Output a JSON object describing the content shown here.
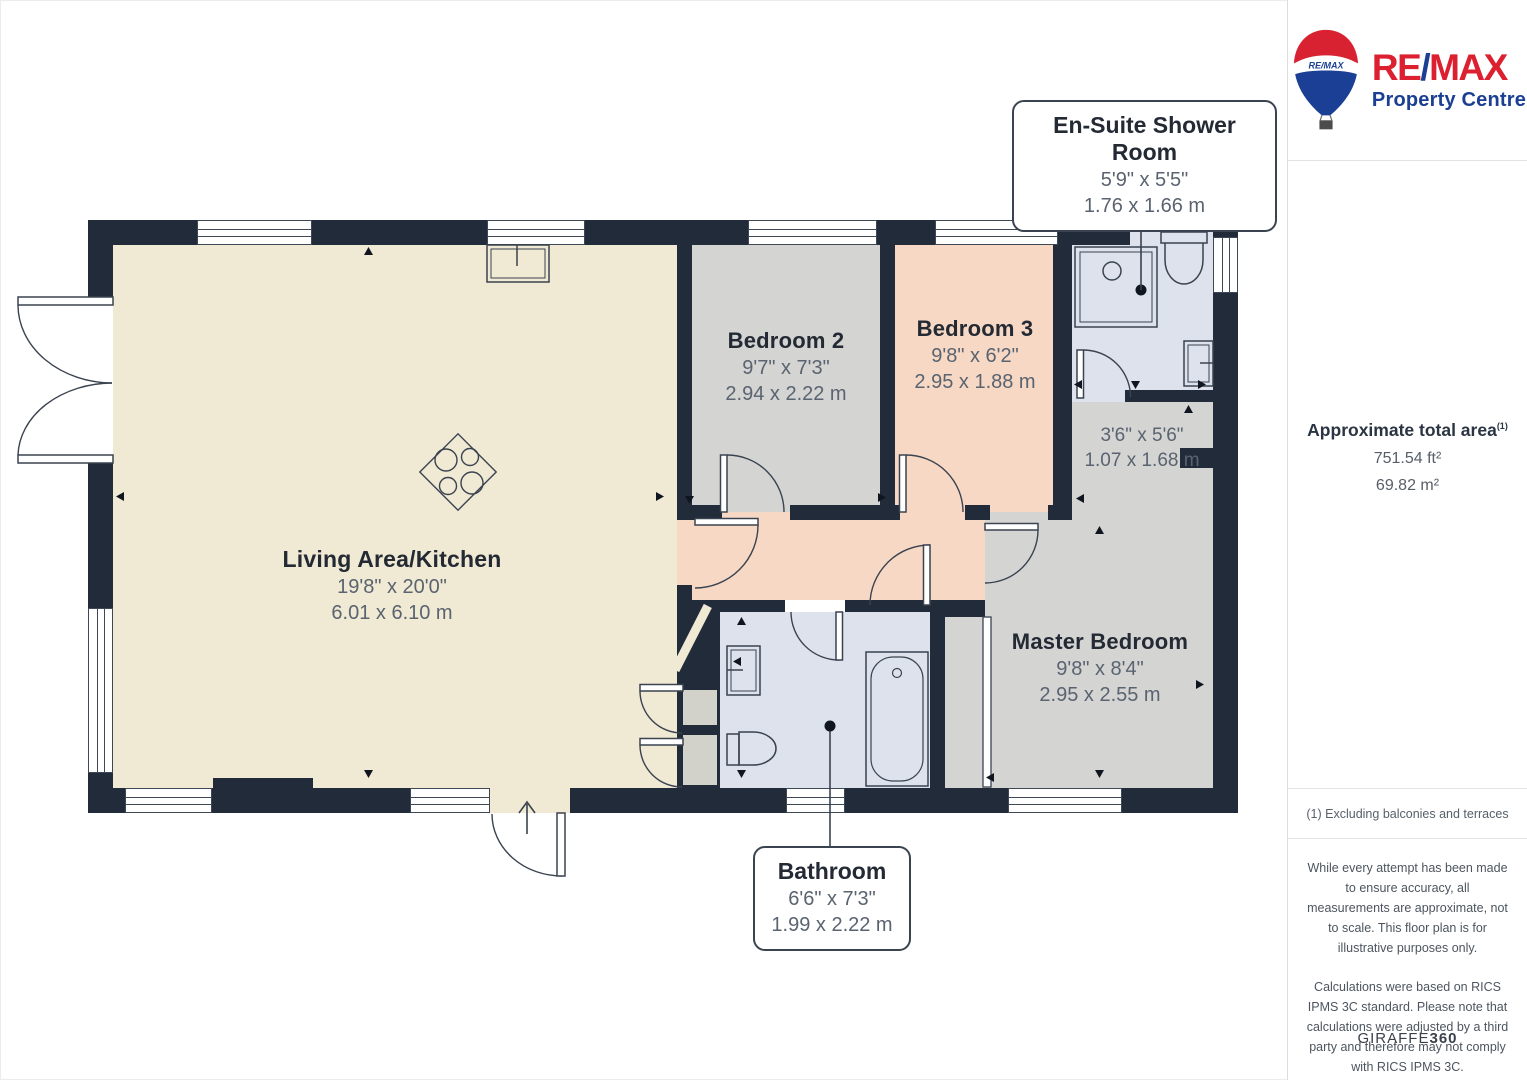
{
  "brand": {
    "balloon_label": "RE/MAX",
    "wordmark_left": "RE",
    "wordmark_slash": "/",
    "wordmark_right": "MAX",
    "tagline": "Property Centre",
    "red": "#dd2030",
    "blue": "#1b3f94"
  },
  "sidebar": {
    "area_title": "Approximate total area",
    "area_sup": "(1)",
    "area_ft": "751.54 ft²",
    "area_m": "69.82 m²",
    "footnote": "(1) Excluding balconies and terraces",
    "disclaimer1": "While every attempt has been made to ensure accuracy, all measurements are approximate, not to scale. This floor plan is for illustrative purposes only.",
    "disclaimer2": "Calculations were based on RICS IPMS 3C standard. Please note that calculations were adjusted by a third party and therefore may not comply with RICS IPMS 3C.",
    "brand_footer_regular": "GIRAFFE",
    "brand_footer_bold": "360"
  },
  "rooms": {
    "living": {
      "name": "Living Area/Kitchen",
      "imperial": "19'8\" x 20'0\"",
      "metric": "6.01 x 6.10 m"
    },
    "bedroom2": {
      "name": "Bedroom 2",
      "imperial": "9'7\" x 7'3\"",
      "metric": "2.94 x 2.22 m"
    },
    "bedroom3": {
      "name": "Bedroom 3",
      "imperial": "9'8\" x 6'2\"",
      "metric": "2.95 x 1.88 m"
    },
    "hallway": {
      "imperial": "3'6\" x 5'6\"",
      "metric": "1.07 x 1.68 m"
    },
    "master": {
      "name": "Master Bedroom",
      "imperial": "9'8\" x 8'4\"",
      "metric": "2.95 x 2.55 m"
    },
    "ensuite": {
      "name": "En-Suite Shower Room",
      "imperial": "5'9\" x 5'5\"",
      "metric": "1.76 x 1.66 m"
    },
    "bathroom": {
      "name": "Bathroom",
      "imperial": "6'6\" x 7'3\"",
      "metric": "1.99 x 2.22 m"
    }
  },
  "colors": {
    "wall": "#212b3a",
    "floor_living": "#f0e9d3",
    "floor_bedroom": "#d4d4d3",
    "floor_peach": "#f7d8c4",
    "floor_wet": "#dee2ed",
    "line": "#3a4350",
    "title_text": "#232a34",
    "dim_text": "#5a6370"
  }
}
